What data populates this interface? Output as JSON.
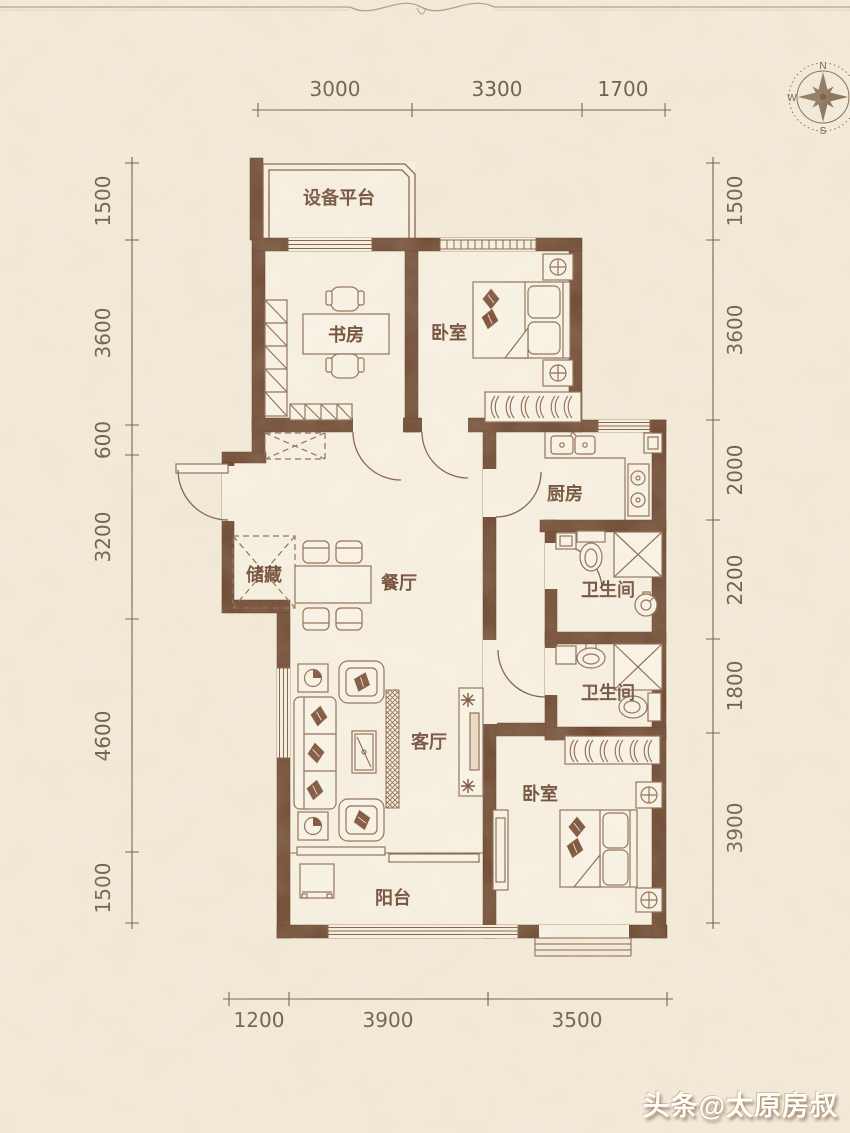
{
  "compass": {
    "north": "N",
    "south": "S",
    "west": "W",
    "east": "E"
  },
  "dimensions": {
    "top": [
      "3000",
      "3300",
      "1700"
    ],
    "left": [
      "1500",
      "3600",
      "600",
      "3200",
      "4600",
      "1500"
    ],
    "right": [
      "1500",
      "3600",
      "2000",
      "2200",
      "1800",
      "3900"
    ],
    "bottom": [
      "1200",
      "3900",
      "3500"
    ]
  },
  "rooms": {
    "equipment_platform": "设备平台",
    "study": "书房",
    "bedroom_top": "卧室",
    "kitchen": "厨房",
    "bathroom_upper": "卫生间",
    "bathroom_lower": "卫生间",
    "storage": "储藏",
    "dining": "餐厅",
    "living": "客厅",
    "bedroom_bottom": "卧室",
    "balcony": "阳台"
  },
  "watermark": {
    "text": "头条@太原房叔"
  },
  "colors": {
    "background": "#f3ead9",
    "floor": "#f7f1e3",
    "wall": "#6e4933",
    "furniture_line": "#8a6850",
    "dimension_text": "#6a5745",
    "room_label": "#6d4b36",
    "watermark_text": "#ffffff"
  }
}
